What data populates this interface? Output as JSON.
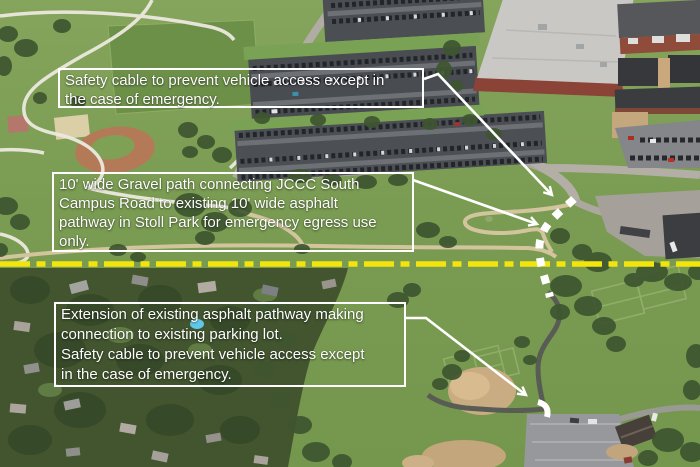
{
  "notes": {
    "top": {
      "label": "Safety cable to prevent vehicle access except in\nthe case of emergency."
    },
    "middle": {
      "label": "10' wide Gravel path connecting JCCC South\nCampus Road to existing 10' wide asphalt\npathway in Stoll Park for emergency egress use\nonly."
    },
    "bottom": {
      "label": "Extension of existing asphalt pathway making\nconnection to existing parking lot.\nSafety cable to prevent vehicle access except\nin the case of emergency."
    }
  },
  "markings": {
    "divider": {
      "style": "dash-dot",
      "color": "#f2e40c"
    },
    "proposed_path": {
      "style": "dashed",
      "color": "#ffffff"
    },
    "entrance_mark": {
      "style": "dash",
      "color": "#ffffff"
    },
    "leader_arrows": {
      "color": "#ffffff"
    }
  },
  "colors": {
    "annotation_text": "#ffffff",
    "annotation_border": "#ffffff"
  }
}
